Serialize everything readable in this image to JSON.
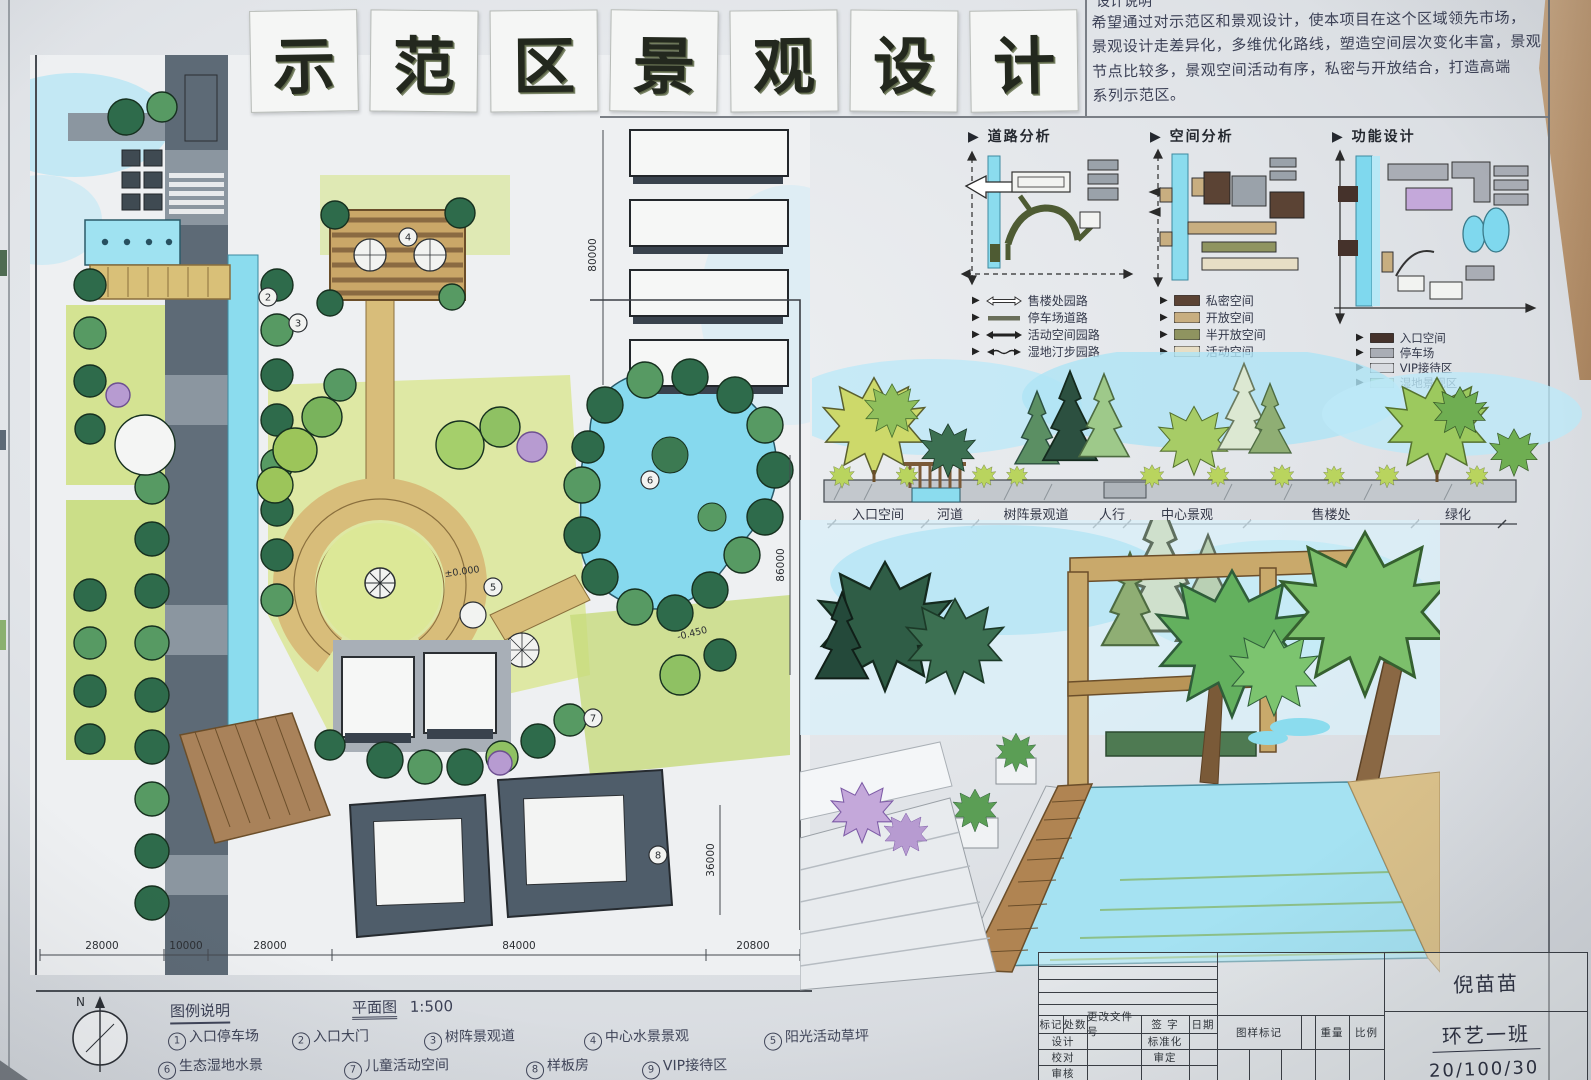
{
  "title": {
    "characters": [
      "示",
      "范",
      "区",
      "景",
      "观",
      "设",
      "计"
    ]
  },
  "description": {
    "heading": "设计说明",
    "lines": [
      "希望通过对示范区和景观设计，使本项目在这个区域领先市场，",
      "景观设计走差异化，多维优化路线，塑造空间层次变化丰富，景观",
      "节点比较多，景观空间活动有序，私密与开放结合，打造高端",
      "系列示范区。"
    ]
  },
  "diagrams": {
    "road": {
      "title": "道路分析",
      "legend": [
        {
          "label": "售楼处园路"
        },
        {
          "label": "停车场道路"
        },
        {
          "label": "活动空间园路"
        },
        {
          "label": "湿地汀步园路"
        }
      ]
    },
    "space": {
      "title": "空间分析",
      "legend": [
        {
          "label": "私密空间",
          "color": "#5b4334"
        },
        {
          "label": "开放空间",
          "color": "#c8ae80"
        },
        {
          "label": "半开放空间",
          "color": "#8f9460"
        },
        {
          "label": "活动空间",
          "color": "#e7dec5"
        }
      ]
    },
    "function": {
      "title": "功能设计",
      "legend": [
        {
          "label": "入口空间",
          "color": "#45322b"
        },
        {
          "label": "停车场",
          "color": "#a9adb5"
        },
        {
          "label": "VIP接待区",
          "color": "#d8dbe0"
        },
        {
          "label": "湿地景观区",
          "color": "#a9d5a1"
        }
      ]
    }
  },
  "section": {
    "labels": [
      "入口空间",
      "河道",
      "树阵景观道",
      "人行",
      "中心景观",
      "售楼处",
      "绿化"
    ]
  },
  "plan": {
    "dims_bottom": [
      "28000",
      "10000",
      "28000",
      "84000",
      "20800"
    ],
    "dim_buildings": "80000",
    "dim_right": "86000",
    "dim_lower_right": "36000",
    "spot_zero": "±0.000",
    "spot_minus": "-0.450",
    "callouts": [
      "2",
      "3",
      "4",
      "5",
      "6",
      "7",
      "8"
    ],
    "north": "N",
    "scale_note": "1:500"
  },
  "legend": {
    "heading": "图例说明",
    "scale_label": "平面图",
    "scale_value": "1:500",
    "items": [
      {
        "no": "1",
        "label": "入口停车场"
      },
      {
        "no": "2",
        "label": "入口大门"
      },
      {
        "no": "3",
        "label": "树阵景观道"
      },
      {
        "no": "4",
        "label": "中心水景景观"
      },
      {
        "no": "5",
        "label": "阳光活动草坪"
      },
      {
        "no": "6",
        "label": "生态湿地水景"
      },
      {
        "no": "7",
        "label": "儿童活动空间"
      },
      {
        "no": "8",
        "label": "样板房"
      },
      {
        "no": "9",
        "label": "VIP接待区"
      }
    ]
  },
  "titleblock": {
    "header": [
      "标记",
      "处数",
      "更改文件号",
      "签 字",
      "日期"
    ],
    "row_design": "设计",
    "row_standard": "标准化",
    "row_proof": "校对",
    "row_approve": "审定",
    "row_review": "审核",
    "drawing_mark": "图样标记",
    "weight": "重量",
    "scale": "比例",
    "name": "倪苗苗",
    "class_name": "环艺一班",
    "date": "20/100/30"
  },
  "colors": {
    "water": "#8bdcee",
    "lawn": "#cfe081",
    "tree_dark": "#2e6b4b",
    "path_tan": "#d8bd7a",
    "building": "#4d5a68",
    "sky": "#b8e8f6"
  }
}
